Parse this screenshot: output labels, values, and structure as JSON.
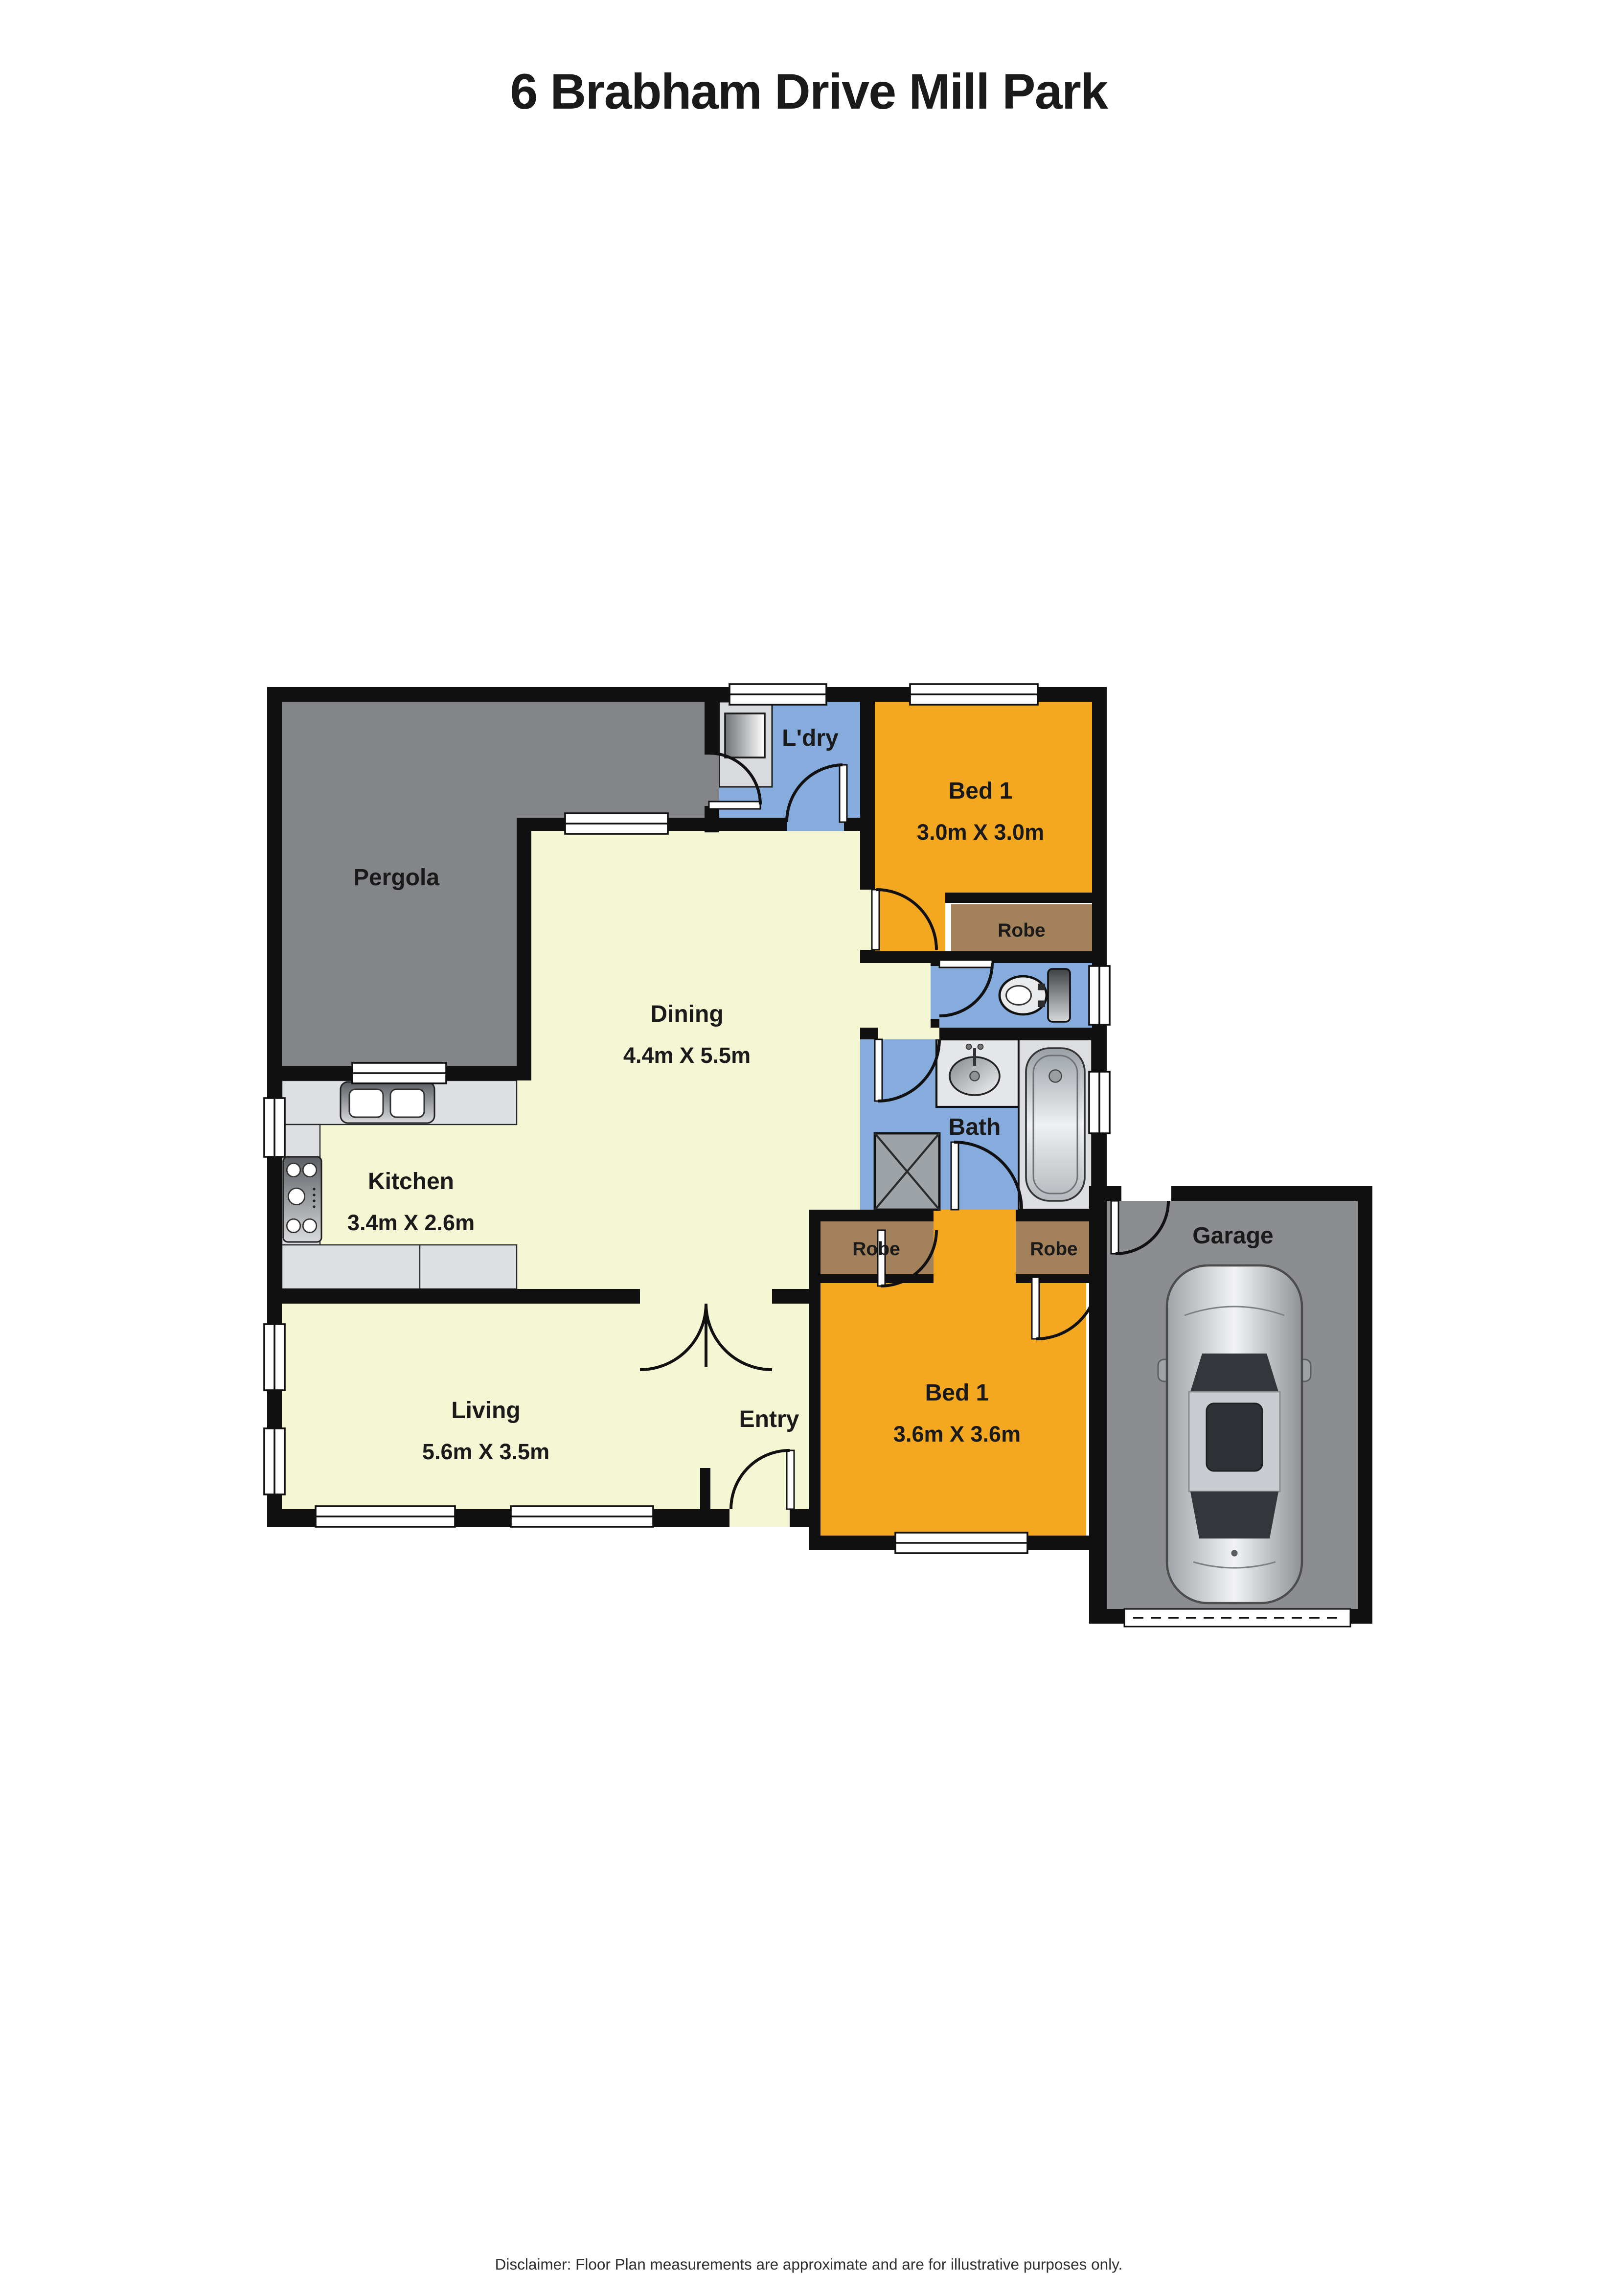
{
  "title": "6 Brabham Drive Mill Park",
  "disclaimer": "Disclaimer: Floor Plan measurements are approximate and are for illustrative purposes only.",
  "rooms": {
    "pergola": {
      "label": "Pergola"
    },
    "laundry": {
      "label": "L'dry"
    },
    "bed1": {
      "label": "Bed 1",
      "dims": "3.0m X 3.0m"
    },
    "bed1_robe": {
      "label": "Robe"
    },
    "dining": {
      "label": "Dining",
      "dims": "4.4m X 5.5m"
    },
    "bath": {
      "label": "Bath"
    },
    "kitchen": {
      "label": "Kitchen",
      "dims": "3.4m X 2.6m"
    },
    "living": {
      "label": "Living",
      "dims": "5.6m X 3.5m"
    },
    "entry": {
      "label": "Entry"
    },
    "bed2": {
      "label": "Bed 1",
      "dims": "3.6m X 3.6m"
    },
    "bed2_robe_left": {
      "label": "Robe"
    },
    "bed2_robe_right": {
      "label": "Robe"
    },
    "garage": {
      "label": "Garage"
    }
  },
  "colors": {
    "wall": "#101010",
    "floor_cream": "#F5F6D3",
    "room_blue": "#85ACDC",
    "room_orange": "#F3A81F",
    "pergola_gray": "#838588",
    "garage_gray": "#8B8D90",
    "robe_brown": "#A2815B",
    "counter_gray": "#DDDFE2"
  }
}
